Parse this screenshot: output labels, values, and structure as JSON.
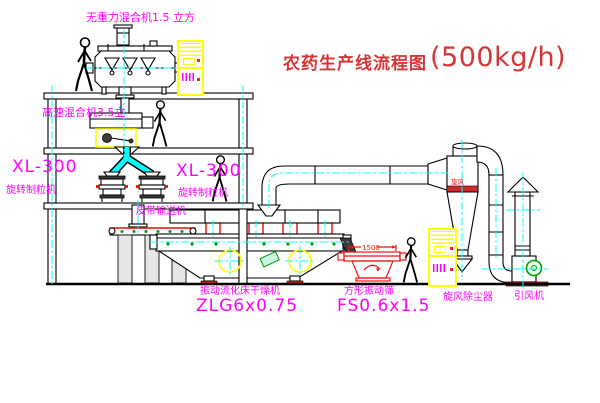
{
  "diagram": {
    "title": {
      "cn": "农药生产线流程图",
      "capacity": "(500kg/h)"
    },
    "equipment_labels": {
      "top_mixer": "无重力混合机1.5 立方",
      "second_mixer": "高速混合机3.5立",
      "granulator_left_model": "XL-300",
      "granulator_left_name": "旋转制粒机",
      "granulator_right_model": "XL-300",
      "granulator_right_name": "旋转制粒机",
      "belt_conveyor": "皮带输送机",
      "dryer_name": "振动流化床干燥机",
      "dryer_model": "ZLG6x0.75",
      "sieve_name": "方形振动筛",
      "sieve_model": "FS0.6x1.5",
      "cyclone_name": "旋风除尘器",
      "fan_name": "引风机",
      "cyclone_tag": "旋风",
      "sieve_dim_mm": "1500"
    },
    "colors": {
      "label_magenta": "#ff00ff",
      "title_red": "#d63535",
      "centerline_cyan": "#00ffff",
      "cabinet_yellow": "#ffff00",
      "sieve_red": "#f11414",
      "motor_green": "#00a000"
    }
  }
}
